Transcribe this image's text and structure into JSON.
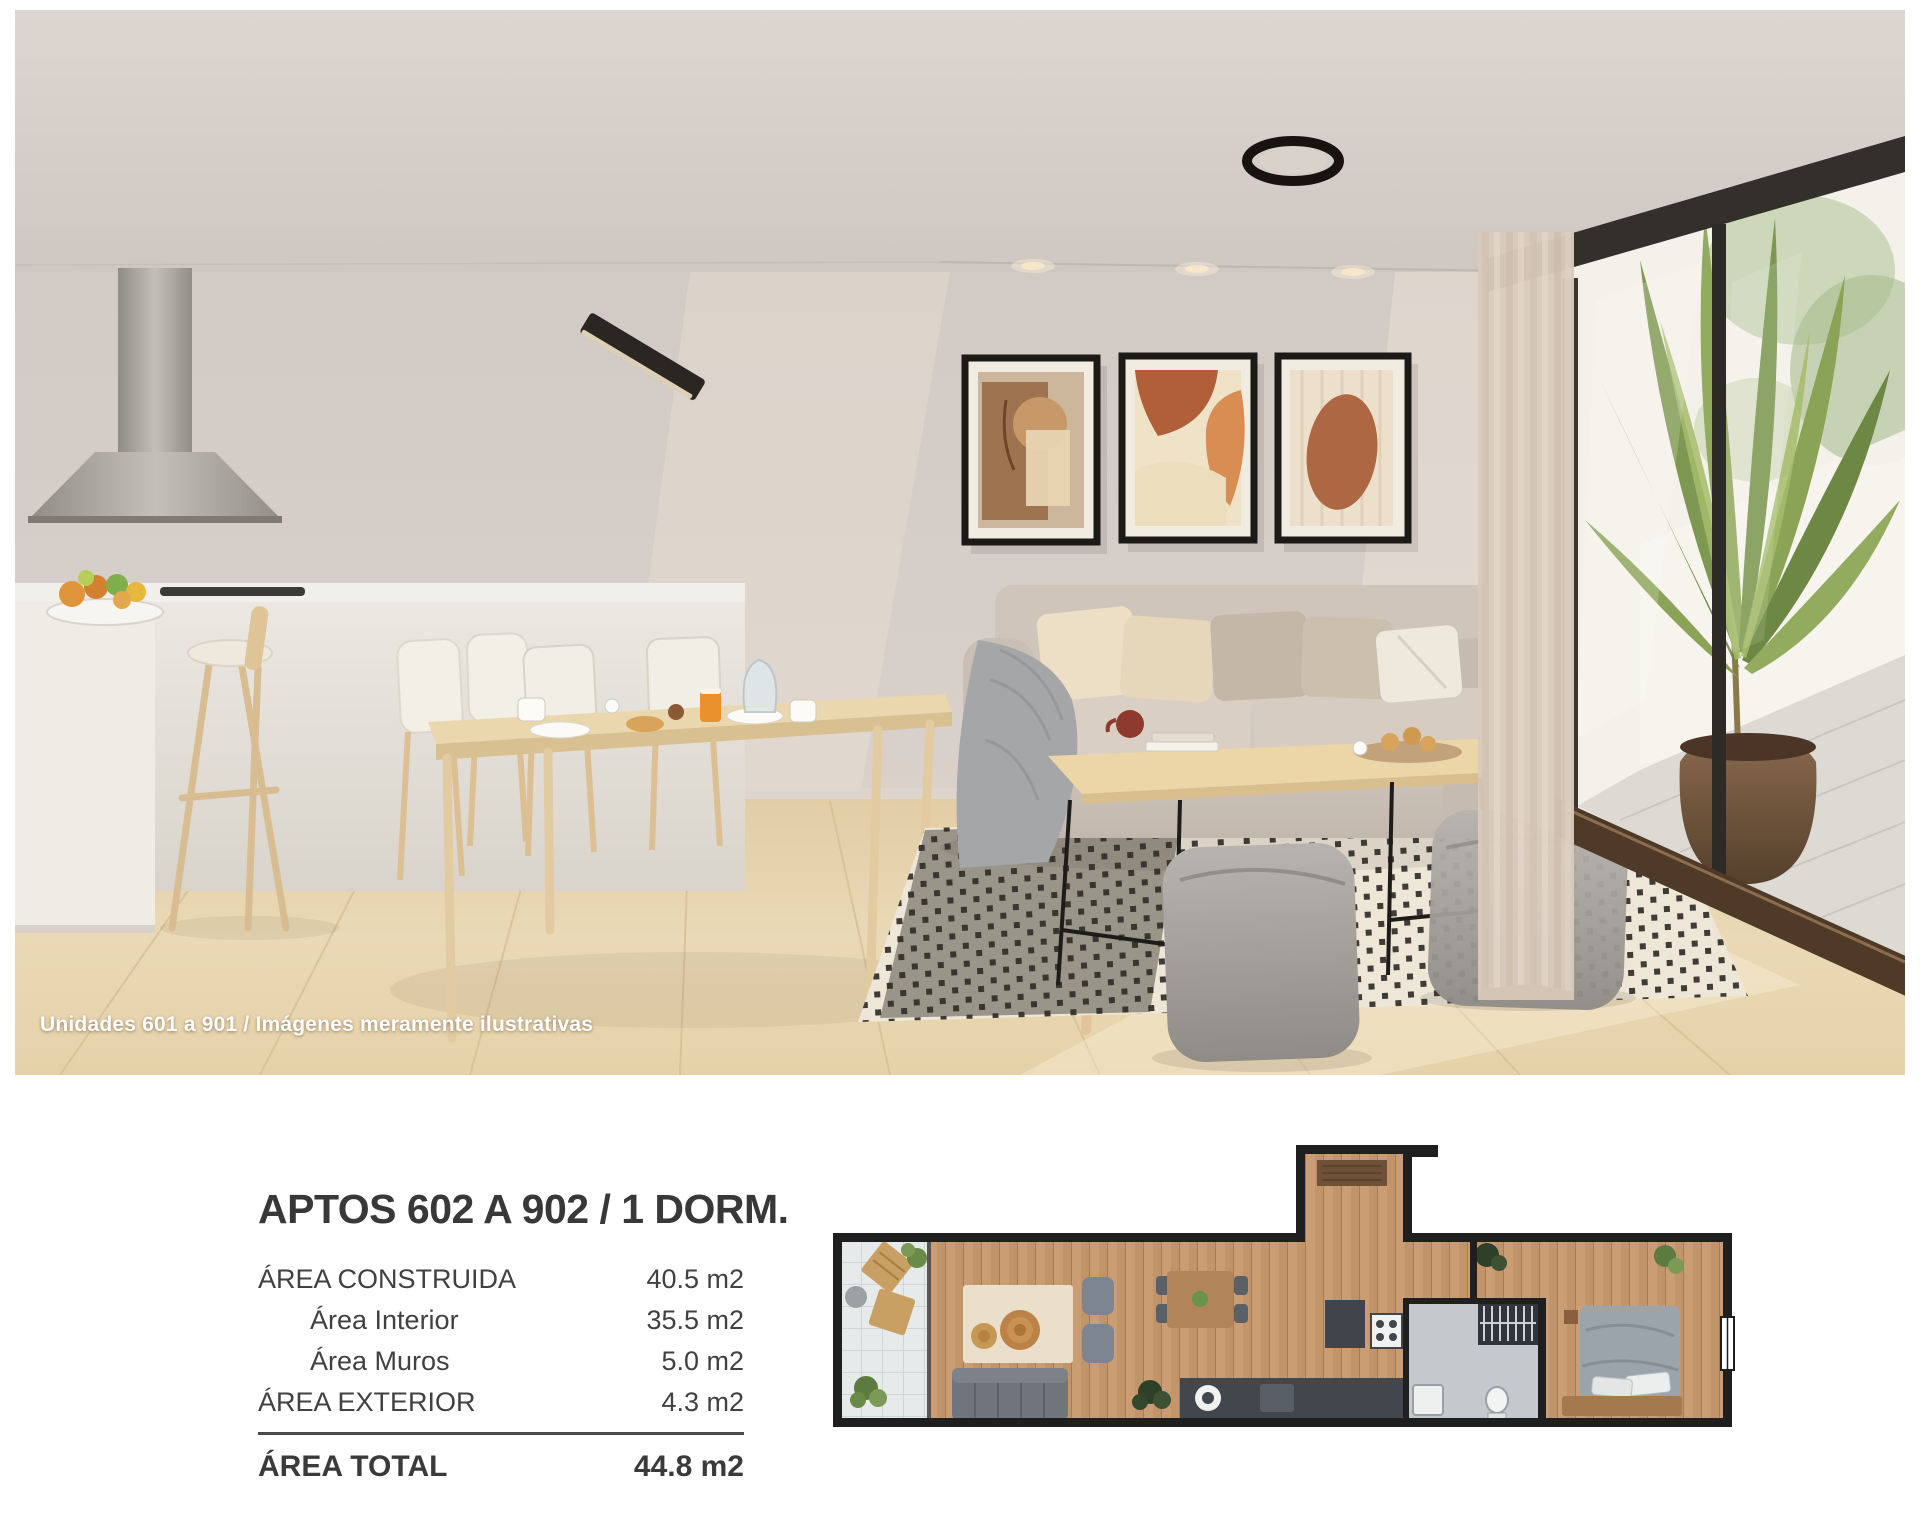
{
  "photo": {
    "caption": "Unidades 601 a 901 / Imágenes meramente ilustrativas"
  },
  "info": {
    "title": "APTOS 602 A 902 / 1 DORM.",
    "rows": [
      {
        "label": "ÁREA CONSTRUIDA",
        "value": "40.5 m2",
        "style": "main"
      },
      {
        "label": "Área Interior",
        "value": "35.5 m2",
        "style": "sub"
      },
      {
        "label": "Área Muros",
        "value": "5.0 m2",
        "style": "sub"
      },
      {
        "label": "ÁREA EXTERIOR",
        "value": "4.3 m2",
        "style": "main"
      }
    ],
    "total": {
      "label": "ÁREA TOTAL",
      "value": "44.8 m2"
    }
  },
  "colors": {
    "text": "#3d3d3d",
    "caption": "#ffffff",
    "wall": "#d3cbc5",
    "floor": "#e7d6b4",
    "plan_wood": "#c2946a",
    "frame_black": "#1c1a17"
  }
}
